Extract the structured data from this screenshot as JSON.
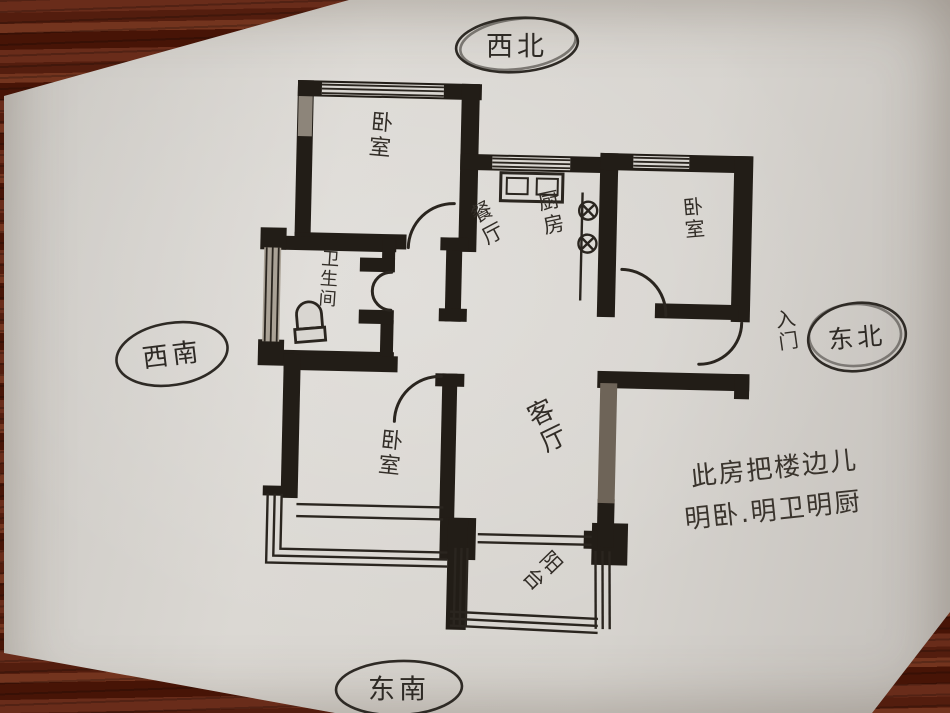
{
  "compass": {
    "north_west": "西北",
    "south_west": "西南",
    "north_east": "东北",
    "south_east": "东南"
  },
  "rooms": {
    "bedroom_top_left": "卧室",
    "dining": "餐厅",
    "kitchen": "厨房",
    "bedroom_top_right": "卧室",
    "bathroom": "卫生间",
    "living": "客厅",
    "bedroom_bottom": "卧室",
    "balcony": "阳台"
  },
  "entrance": {
    "label": "入门"
  },
  "note": {
    "line1": "此房把楼边儿",
    "line2": "明卧.明卫明厨"
  },
  "colors": {
    "paper": "#d9d6d1",
    "wood": "#5c2414",
    "ink": "#2e2a25",
    "wall": "#221d17",
    "pencil": "#6e6458"
  }
}
